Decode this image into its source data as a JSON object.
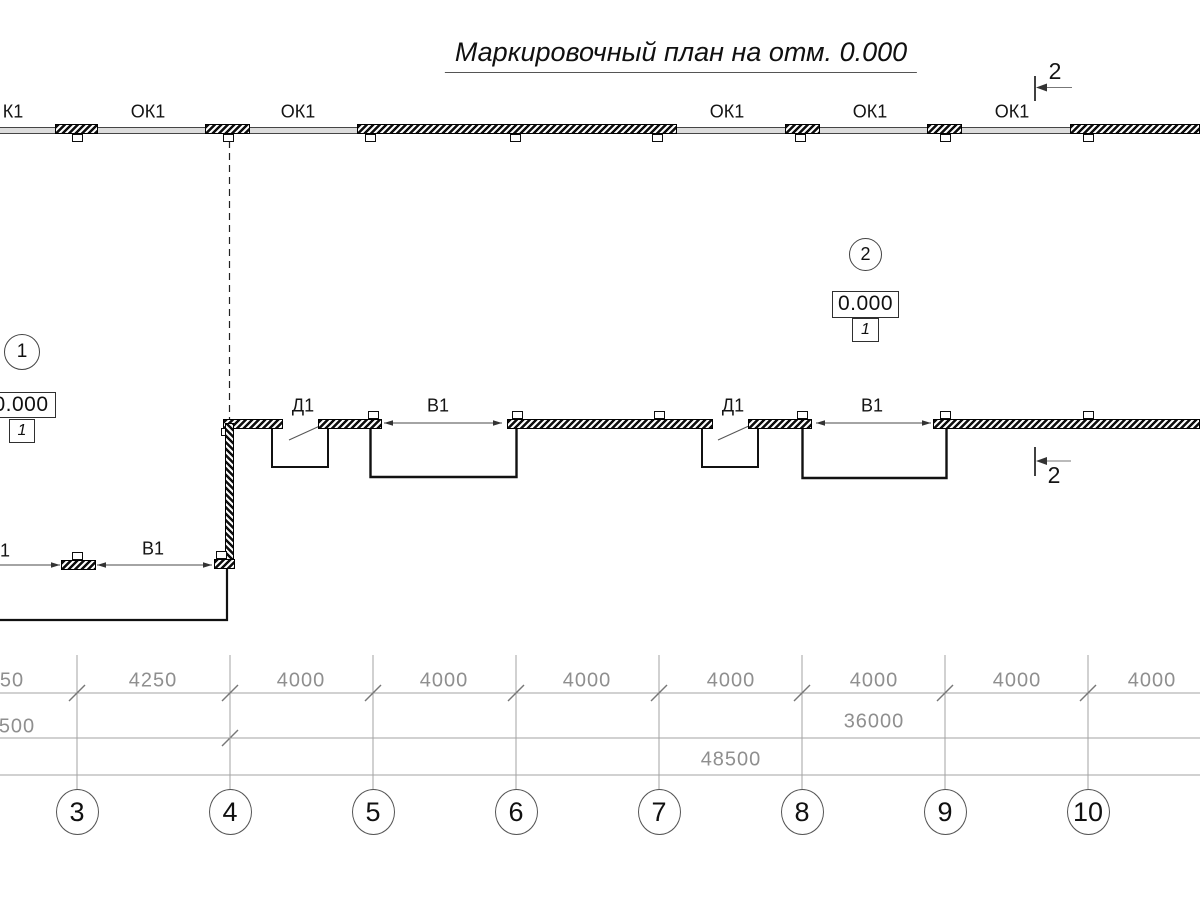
{
  "title": "Маркировочный план на отм. 0.000",
  "section_mark_label": "2",
  "window_labels": [
    "К1",
    "ОК1",
    "ОК1",
    "ОК1",
    "ОК1",
    "ОК1"
  ],
  "door_labels": [
    "Д1",
    "Д1"
  ],
  "gate_labels": [
    "В1",
    "В1",
    "В1"
  ],
  "gate_label_partial": "1",
  "level_marks": {
    "left": {
      "bubble": "1",
      "elevation": "0.000",
      "note": "1"
    },
    "right": {
      "bubble": "2",
      "elevation": "0.000",
      "note": "1"
    }
  },
  "dimensions": {
    "row1": [
      "50",
      "4250",
      "4000",
      "4000",
      "4000",
      "4000",
      "4000",
      "4000",
      "4000"
    ],
    "row2_left_partial": "500",
    "row2_total": "36000",
    "row3_total": "48500"
  },
  "grid_axes": [
    "3",
    "4",
    "5",
    "6",
    "7",
    "8",
    "9",
    "10"
  ],
  "colors": {
    "line": "#141414",
    "dimension": "#8f8f8f"
  }
}
